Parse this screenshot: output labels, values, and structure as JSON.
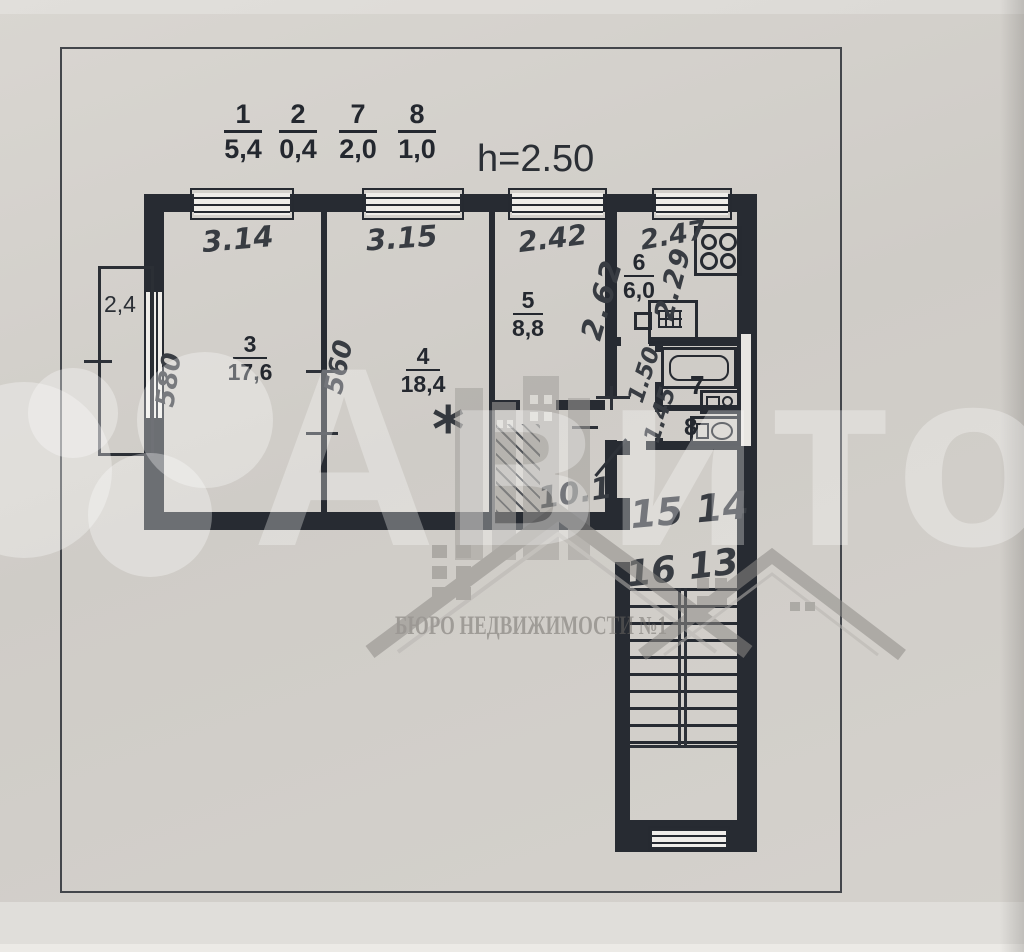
{
  "header": {
    "room_fractions": [
      {
        "num": "1",
        "area": "5,4"
      },
      {
        "num": "2",
        "area": "0,4"
      },
      {
        "num": "7",
        "area": "2,0"
      },
      {
        "num": "8",
        "area": "1,0"
      }
    ],
    "ceiling_height": "h=2.50"
  },
  "rooms": {
    "room3": {
      "num": "3",
      "area": "17,6"
    },
    "room4": {
      "num": "4",
      "area": "18,4"
    },
    "room5": {
      "num": "5",
      "area": "8,8"
    },
    "kitchen": {
      "num": "6",
      "area": "6,0"
    },
    "bathroom": {
      "num": "7"
    },
    "wc": {
      "num": "8"
    },
    "balcony": {
      "area": "2,4"
    }
  },
  "dims": {
    "w3": "3.14",
    "w4": "3.15",
    "w5": "2.42",
    "w6": "2.47",
    "d3": "580",
    "d4": "560",
    "d5": "2.62",
    "d6": "2.29",
    "b1": "1.50",
    "b2": "1.45",
    "hall": "10.1",
    "apt_row1": "15 14",
    "apt_row2": "16 13",
    "star": "*"
  },
  "watermarks": {
    "avito": "Авито",
    "agency": "БЮРО НЕДВИЖИМОСТИ №1"
  },
  "colors": {
    "paper": "#d2cfca",
    "ink": "#272b32",
    "pencil": "#383c42",
    "watermark_white": "rgba(255,255,255,0.30)",
    "watermark_gray": "#8d8a86"
  }
}
